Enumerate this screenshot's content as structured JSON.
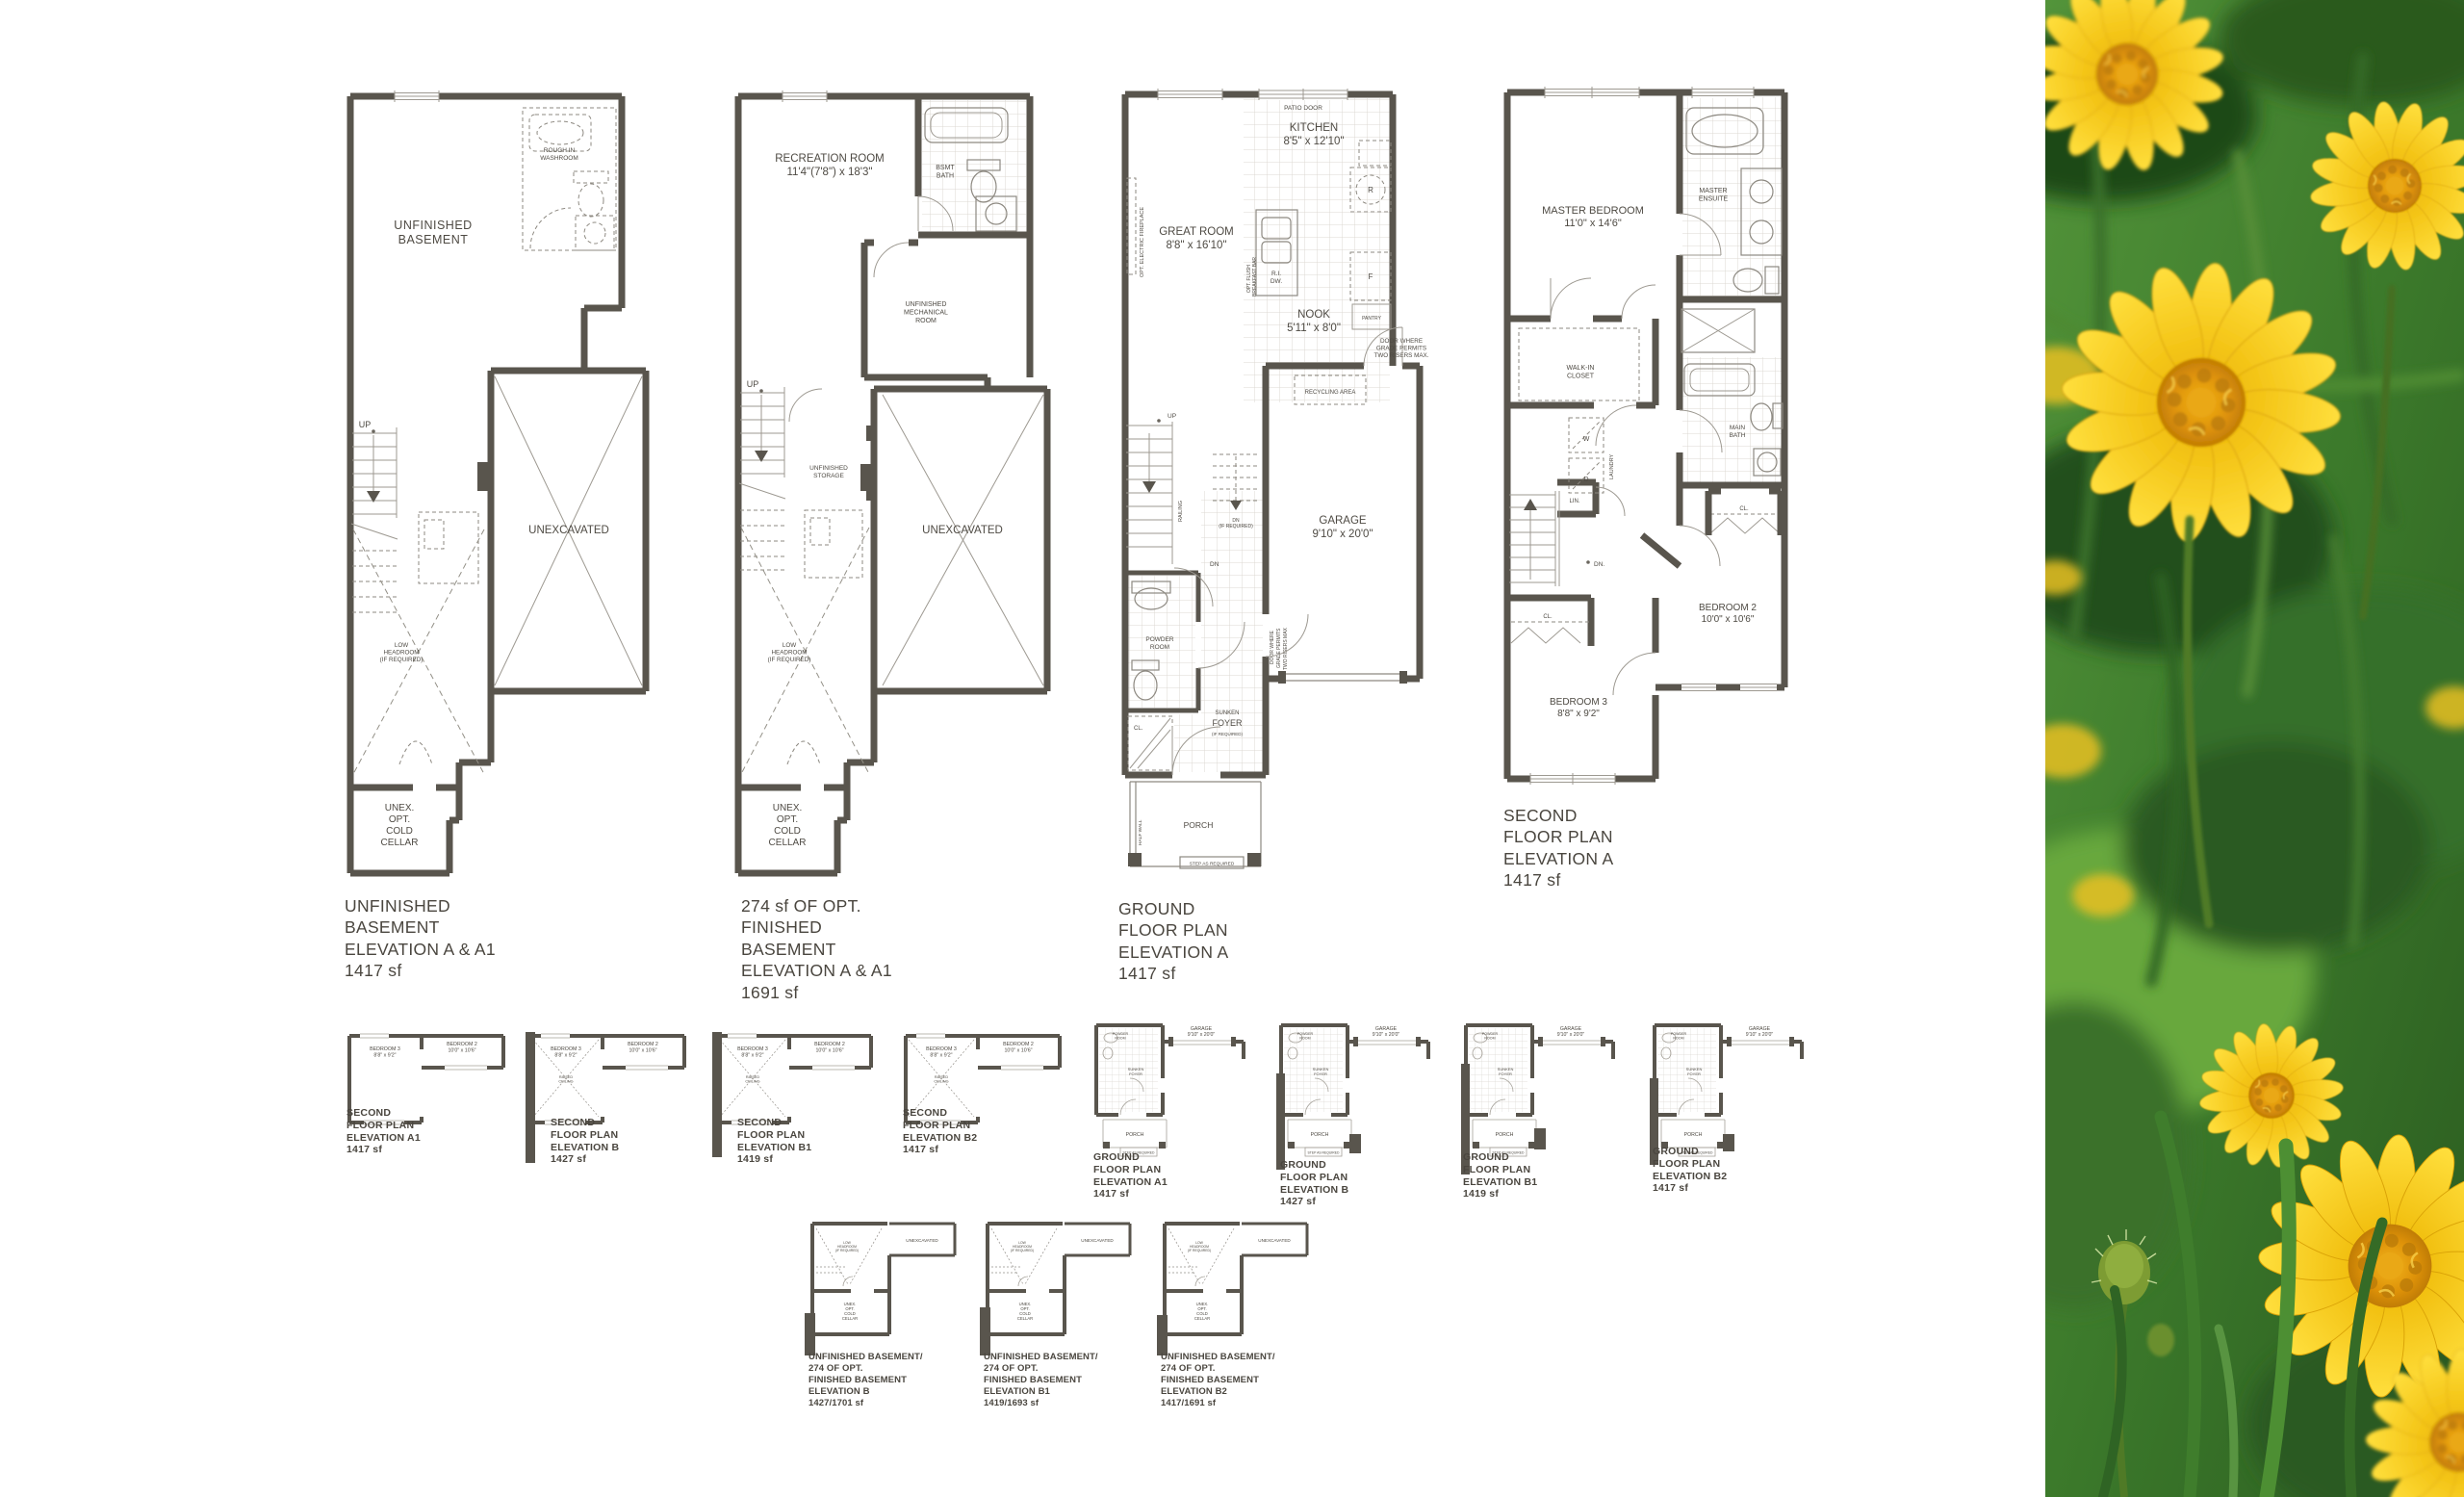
{
  "document": {
    "type": "floor-plan-brochure"
  },
  "colors": {
    "wall": "#59554d",
    "line": "#9d9991",
    "text": "#4a463f",
    "tile": "#dbd8d2",
    "paper": "#ffffff",
    "flower_petal": "#f8c812",
    "flower_center": "#d9900a",
    "foliage_dark": "#2c5e21",
    "foliage_light": "#74b244"
  },
  "plans": {
    "basement_a": {
      "caption": "UNFINISHED\nBASEMENT\nELEVATION A & A1\n1417 sf",
      "labels": {
        "room": "UNFINISHED\nBASEMENT",
        "washroom": "ROUGH IN\nWASHROOM",
        "up": "UP",
        "unexcavated": "UNEXCAVATED",
        "low_headroom": "LOW\nHEADROOM\n(IF REQUIRED)",
        "cold_cellar": "UNEX.\nOPT.\nCOLD\nCELLAR"
      }
    },
    "basement_finished": {
      "caption": "274 sf OF OPT.\nFINISHED\nBASEMENT\nELEVATION A & A1\n1691 sf",
      "labels": {
        "rec_room": "RECREATION ROOM\n11'4\"(7'8\") x 18'3\"",
        "bath": "BSMT\nBATH",
        "mechanical": "UNFINISHED\nMECHANICAL\nROOM",
        "storage": "UNFINISHED\nSTORAGE",
        "up": "UP",
        "unexcavated": "UNEXCAVATED",
        "low_headroom": "LOW\nHEADROOM\n(IF REQUIRED)",
        "cold_cellar": "UNEX.\nOPT.\nCOLD\nCELLAR"
      }
    },
    "ground": {
      "caption": "GROUND\nFLOOR PLAN\nELEVATION A\n1417 sf",
      "labels": {
        "patio_door": "PATIO DOOR",
        "kitchen": "KITCHEN\n8'5\" x 12'10\"",
        "great_room": "GREAT ROOM\n8'8\" x 16'10\"",
        "fireplace": "OPT. ELECTRIC FIREPLACE",
        "breakfast_bar_1": "OPT. FLUSH",
        "breakfast_bar_2": "BREAKFAST BAR",
        "ri_dw": "R.I.\nDW.",
        "range": "R",
        "fridge": "F",
        "pantry": "PANTRY",
        "nook": "NOOK\n5'11\" x 8'0\"",
        "grade_note": "DOOR WHERE\nGRADE PERMITS\nTWO RISERS MAX.",
        "recycling": "RECYCLING AREA",
        "up": "UP",
        "dn": "DN",
        "dn_opt": "DN\n(IF REQUIRED)",
        "railing": "RAILING",
        "garage": "GARAGE\n9'10\" x 20'0\"",
        "grade_v1": "DOOR WHERE",
        "grade_v2": "GRADE PERMITS",
        "grade_v3": "TWO RISERS MAX",
        "powder": "POWDER\nROOM",
        "sunken": "SUNKEN",
        "foyer": "FOYER",
        "if_required": "(IF REQUIRED)",
        "closet": "CL.",
        "porch": "PORCH",
        "half_wall": "HALF WALL",
        "step": "STEP AS REQUIRED"
      }
    },
    "second": {
      "caption": "SECOND\nFLOOR PLAN\nELEVATION A\n1417 sf",
      "labels": {
        "master": "MASTER BEDROOM\n11'0\" x 14'6\"",
        "ensuite": "MASTER\nENSUITE",
        "wic": "WALK-IN\nCLOSET",
        "washer": "W",
        "dryer": "D",
        "laundry": "LAUNDRY",
        "linen": "LIN.",
        "dn": "DN.",
        "closet": "CL.",
        "main_bath": "MAIN\nBATH",
        "bed2": "BEDROOM 2\n10'0\" x 10'6\"",
        "bed3": "BEDROOM 3\n8'8\" x 9'2\""
      }
    }
  },
  "thumbnails": {
    "shared": {
      "bed2": "BEDROOM 2\n10'0\" x 10'6\"",
      "bed3": "BEDROOM 3\n8'8\" x 9'2\"",
      "raised_ceiling": "RAISED\nCEILING",
      "garage": "GARAGE\n9'10\" x 20'0\"",
      "porch": "PORCH",
      "powder": "POWDER\nROOM",
      "foyer": "SUNKEN\nFOYER",
      "step": "STEP AS REQUIRED",
      "unexcavated": "UNEXCAVATED",
      "low_headroom": "LOW\nHEADROOM\n(IF REQUIRED)",
      "cold_cellar": "UNEX.\nOPT.\nCOLD\nCELLAR"
    },
    "second": [
      {
        "caption": "SECOND\nFLOOR PLAN\nELEVATION A1\n1417 sf"
      },
      {
        "caption": "SECOND\nFLOOR PLAN\nELEVATION B\n1427 sf"
      },
      {
        "caption": "SECOND\nFLOOR PLAN\nELEVATION B1\n1419 sf"
      },
      {
        "caption": "SECOND\nFLOOR PLAN\nELEVATION B2\n1417 sf"
      }
    ],
    "ground": [
      {
        "caption": "GROUND\nFLOOR PLAN\nELEVATION A1\n1417 sf"
      },
      {
        "caption": "GROUND\nFLOOR PLAN\nELEVATION B\n1427 sf"
      },
      {
        "caption": "GROUND\nFLOOR PLAN\nELEVATION B1\n1419 sf"
      },
      {
        "caption": "GROUND\nFLOOR PLAN\nELEVATION B2\n1417 sf"
      }
    ],
    "basement": [
      {
        "caption": "UNFINISHED BASEMENT/\n274 OF OPT.\nFINISHED BASEMENT\nELEVATION B\n1427/1701 sf"
      },
      {
        "caption": "UNFINISHED BASEMENT/\n274 OF OPT.\nFINISHED BASEMENT\nELEVATION B1\n1419/1693 sf"
      },
      {
        "caption": "UNFINISHED BASEMENT/\n274 OF OPT.\nFINISHED BASEMENT\nELEVATION B2\n1417/1691 sf"
      }
    ]
  }
}
